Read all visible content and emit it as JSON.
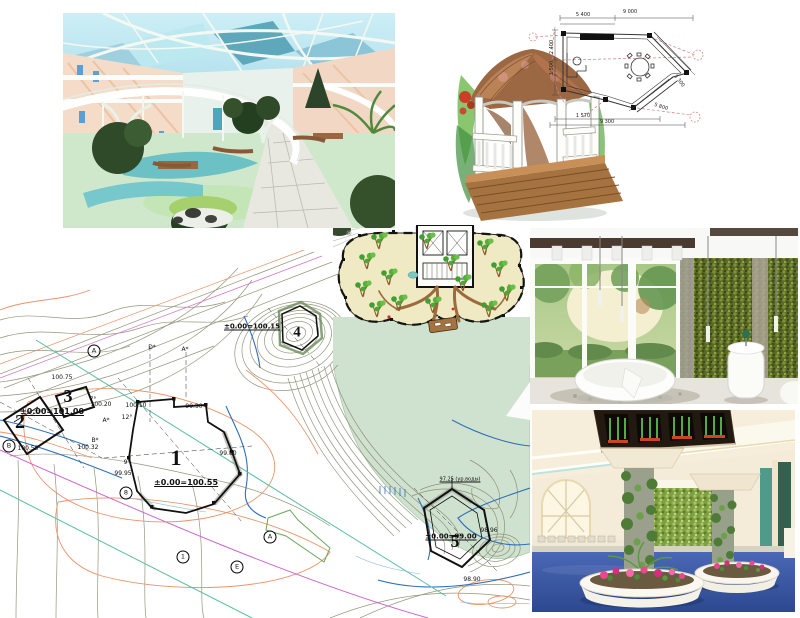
{
  "page": {
    "width": 800,
    "height": 618,
    "background": "#ffffff"
  },
  "palette": {
    "lake_green": "#cfe2cf",
    "contour_olive": "#8a8a6e",
    "contour_orange": "#e8956a",
    "utility_blue": "#2f6fbd",
    "utility_teal": "#58bfa0",
    "utility_magenta": "#cc66cc",
    "road_pink": "#d478c8",
    "plan_floor_cream": "#efe9c4",
    "tree_green": "#55b03a",
    "path_brown": "#9c6b3c",
    "sky_blue": "#aadce8",
    "atrium_floor_green": "#cfe8cc",
    "green_wall": "#5f7029",
    "hall_floor_blue": "#3a58a8",
    "ceiling_cream": "#f4ecd8",
    "flower_pink": "#e8488f",
    "sketch_roof_brown": "#9c6844",
    "plan_line_red": "#c06060"
  },
  "site_plan": {
    "buildings": [
      {
        "number": "1",
        "elevation": "±0.00=100.55"
      },
      {
        "number": "2",
        "elevation": "±0.00=101.00"
      },
      {
        "number": "3",
        "elevation": ""
      },
      {
        "number": "4",
        "elevation": "±0.00=100.15"
      },
      {
        "number": "5",
        "elevation": "±0.00=99.00"
      }
    ],
    "water_level_note": "97.25 (ур.воды)",
    "labels": [
      {
        "t": "1",
        "k": "building",
        "x": 176,
        "y": 208,
        "fs": 22
      },
      {
        "t": "2",
        "k": "building",
        "x": 20,
        "y": 172,
        "fs": 20
      },
      {
        "t": "3",
        "k": "building",
        "x": 68,
        "y": 146,
        "fs": 18
      },
      {
        "t": "4",
        "k": "building",
        "x": 297,
        "y": 83,
        "fs": 15
      },
      {
        "t": "5",
        "k": "building",
        "x": 455,
        "y": 291,
        "fs": 18
      },
      {
        "t": "±0.00=100.55",
        "k": "elev",
        "x": 186,
        "y": 233,
        "fs": 8
      },
      {
        "t": "±0.00=101.00",
        "k": "elev",
        "x": 52,
        "y": 162,
        "fs": 8
      },
      {
        "t": "±0.00=100.15",
        "k": "elev",
        "x": 252,
        "y": 77,
        "fs": 7
      },
      {
        "t": "±0.00=99.00",
        "k": "elev",
        "x": 451,
        "y": 287,
        "fs": 7
      },
      {
        "t": "97.25 (ур.воды)",
        "k": "note",
        "x": 460,
        "y": 230
      },
      {
        "t": "A",
        "k": "circled",
        "x": 94,
        "y": 101
      },
      {
        "t": "B",
        "k": "circled",
        "x": 9,
        "y": 196
      },
      {
        "t": "8",
        "k": "circled",
        "x": 126,
        "y": 243
      },
      {
        "t": "1",
        "k": "circled",
        "x": 183,
        "y": 307
      },
      {
        "t": "E",
        "k": "circled",
        "x": 237,
        "y": 317
      },
      {
        "t": "A",
        "k": "circled",
        "x": 270,
        "y": 287
      },
      {
        "t": "D*",
        "k": "small",
        "x": 152,
        "y": 98
      },
      {
        "t": "A*",
        "k": "small",
        "x": 185,
        "y": 100
      },
      {
        "t": "A*",
        "k": "small",
        "x": 106,
        "y": 171
      },
      {
        "t": "B*",
        "k": "small",
        "x": 95,
        "y": 191
      },
      {
        "t": "7°",
        "k": "small",
        "x": 93,
        "y": 150
      },
      {
        "t": "12°",
        "k": "small",
        "x": 127,
        "y": 168
      },
      {
        "t": "9°",
        "k": "small",
        "x": 127,
        "y": 213
      },
      {
        "t": "100.75",
        "k": "small",
        "x": 62,
        "y": 128
      },
      {
        "t": "100.20",
        "k": "small",
        "x": 101,
        "y": 155
      },
      {
        "t": "100.10",
        "k": "small",
        "x": 136,
        "y": 156
      },
      {
        "t": "99.90",
        "k": "small",
        "x": 194,
        "y": 157
      },
      {
        "t": "99.80",
        "k": "small",
        "x": 228,
        "y": 204
      },
      {
        "t": "100.55",
        "k": "small",
        "x": 28,
        "y": 199
      },
      {
        "t": "100.32",
        "k": "small",
        "x": 88,
        "y": 198
      },
      {
        "t": "99.95",
        "k": "small",
        "x": 123,
        "y": 224
      },
      {
        "t": "98.96",
        "k": "small",
        "x": 489,
        "y": 281
      },
      {
        "t": "98.90",
        "k": "small",
        "x": 472,
        "y": 330
      }
    ]
  },
  "gazebo_plan": {
    "dimensions": [
      {
        "t": "5 400",
        "x": 128,
        "y": 10
      },
      {
        "t": "9 000",
        "x": 175,
        "y": 7
      },
      {
        "t": "2 400",
        "x": 97,
        "y": 42,
        "r": -90
      },
      {
        "t": "1 500",
        "x": 97,
        "y": 63,
        "r": -90
      },
      {
        "t": "3 300",
        "x": 224,
        "y": 76,
        "r": 52
      },
      {
        "t": "5 800",
        "x": 206,
        "y": 102,
        "r": 18
      },
      {
        "t": "1 570",
        "x": 128,
        "y": 111
      },
      {
        "t": "9 300",
        "x": 152,
        "y": 117
      }
    ]
  }
}
